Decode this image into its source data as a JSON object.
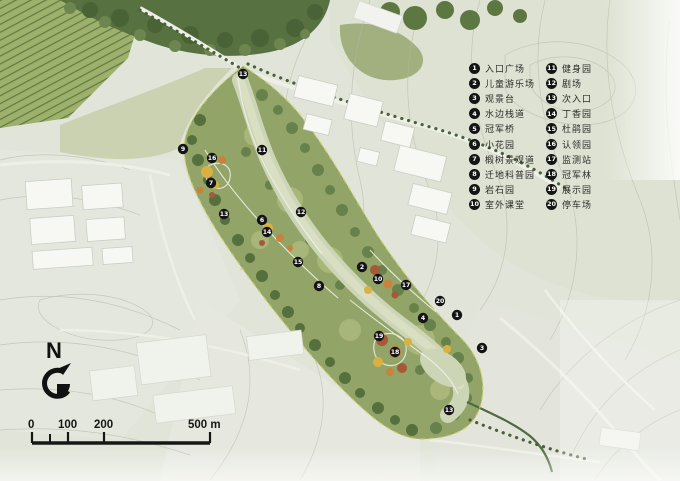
{
  "north_arrow": {
    "label": "N"
  },
  "scale_bar": {
    "labels": {
      "l0": "0",
      "l100": "100",
      "l200": "200",
      "l500": "500 m"
    }
  },
  "legend": {
    "items": [
      {
        "num": "1",
        "label": "入口广场"
      },
      {
        "num": "2",
        "label": "儿童游乐场"
      },
      {
        "num": "3",
        "label": "观景台"
      },
      {
        "num": "4",
        "label": "水边栈道"
      },
      {
        "num": "5",
        "label": "冠军桥"
      },
      {
        "num": "6",
        "label": "小花园"
      },
      {
        "num": "7",
        "label": "椴树景观道"
      },
      {
        "num": "8",
        "label": "迁地科普园"
      },
      {
        "num": "9",
        "label": "岩石园"
      },
      {
        "num": "10",
        "label": "室外课堂"
      },
      {
        "num": "11",
        "label": "健身园"
      },
      {
        "num": "12",
        "label": "剧场"
      },
      {
        "num": "13",
        "label": "次入口"
      },
      {
        "num": "14",
        "label": "丁香园"
      },
      {
        "num": "15",
        "label": "杜鹃园"
      },
      {
        "num": "16",
        "label": "认领园"
      },
      {
        "num": "17",
        "label": "监测站"
      },
      {
        "num": "18",
        "label": "冠军林"
      },
      {
        "num": "19",
        "label": "展示园"
      },
      {
        "num": "20",
        "label": "停车场"
      }
    ]
  },
  "markers": [
    {
      "num": "13",
      "x": 243,
      "y": 74
    },
    {
      "num": "9",
      "x": 183,
      "y": 149
    },
    {
      "num": "16",
      "x": 212,
      "y": 158
    },
    {
      "num": "11",
      "x": 262,
      "y": 150
    },
    {
      "num": "7",
      "x": 211,
      "y": 183
    },
    {
      "num": "13",
      "x": 224,
      "y": 214
    },
    {
      "num": "12",
      "x": 301,
      "y": 212
    },
    {
      "num": "6",
      "x": 262,
      "y": 220
    },
    {
      "num": "14",
      "x": 267,
      "y": 232
    },
    {
      "num": "15",
      "x": 298,
      "y": 262
    },
    {
      "num": "2",
      "x": 362,
      "y": 267
    },
    {
      "num": "10",
      "x": 378,
      "y": 279
    },
    {
      "num": "8",
      "x": 319,
      "y": 286
    },
    {
      "num": "17",
      "x": 406,
      "y": 285
    },
    {
      "num": "20",
      "x": 440,
      "y": 301
    },
    {
      "num": "4",
      "x": 423,
      "y": 318
    },
    {
      "num": "1",
      "x": 457,
      "y": 315
    },
    {
      "num": "19",
      "x": 379,
      "y": 336
    },
    {
      "num": "3",
      "x": 482,
      "y": 348
    },
    {
      "num": "18",
      "x": 395,
      "y": 352
    },
    {
      "num": "13",
      "x": 449,
      "y": 410
    }
  ],
  "colors": {
    "base_terrain": "#e1e5d9",
    "forest_green": "#587140",
    "park_green": "#93a469",
    "river": "#ccd5b5",
    "flower_yellow": "#d9b140",
    "flower_orange": "#c8823b",
    "flower_red": "#a75836",
    "marker_bg": "#141414",
    "marker_text": "#ffffff"
  }
}
